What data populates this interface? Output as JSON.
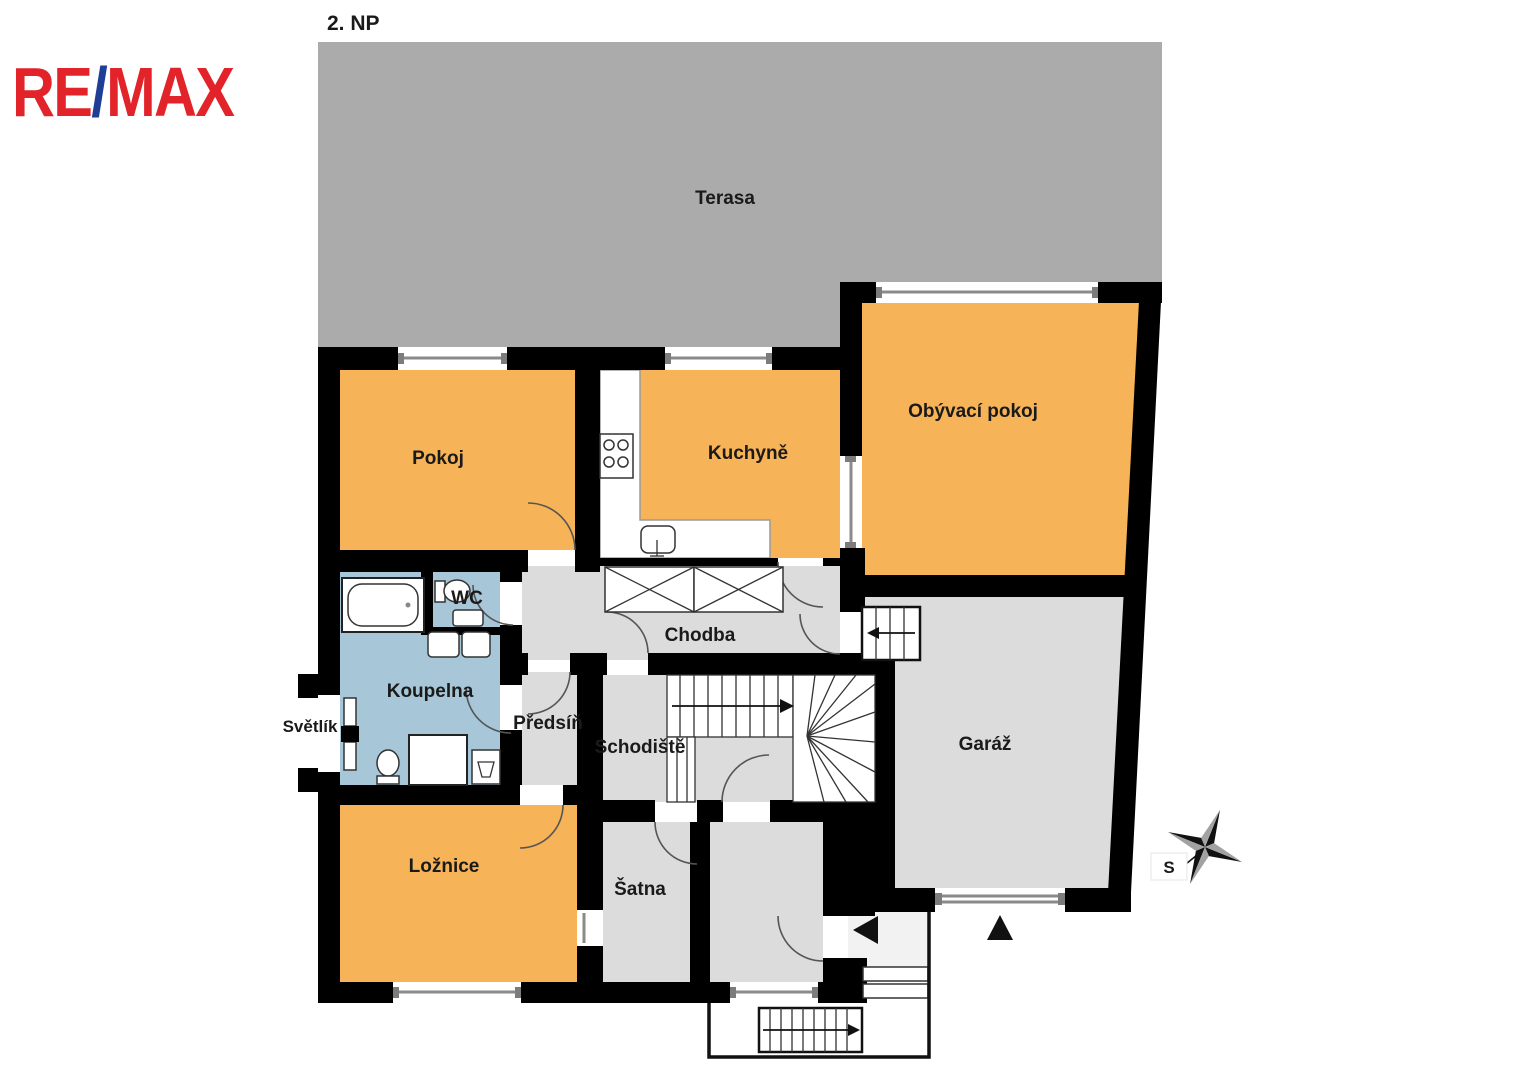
{
  "floor_plan": {
    "title": "2. NP",
    "brand": {
      "logo_re": "RE",
      "logo_slash": "/",
      "logo_max": "MAX"
    },
    "rooms": {
      "terasa": "Terasa",
      "pokoj": "Pokoj",
      "kuchyne": "Kuchyně",
      "obyvaci_pokoj": "Obývací pokoj",
      "wc": "WC",
      "chodba": "Chodba",
      "koupelna": "Koupelna",
      "svetlik": "Světlík",
      "predsin": "Předsíň",
      "schodiste": "Schodiště",
      "garaz": "Garáž",
      "loznice": "Ložnice",
      "satna": "Šatna"
    },
    "compass": {
      "north_label": "S"
    }
  },
  "colors": {
    "wall": "#000000",
    "terrace": "#ababab",
    "room_gray": "#dcdcdc",
    "room_orange": "#f6b357",
    "room_blue": "#a7c6d8",
    "vestibule": "#f2f2f2",
    "window_line": "#8a8a8a",
    "brand_red": "#e2232a",
    "brand_blue": "#1f3e95",
    "star_dark": "#111111",
    "star_light": "#a2a2a2",
    "text": "#1a1a1a"
  }
}
